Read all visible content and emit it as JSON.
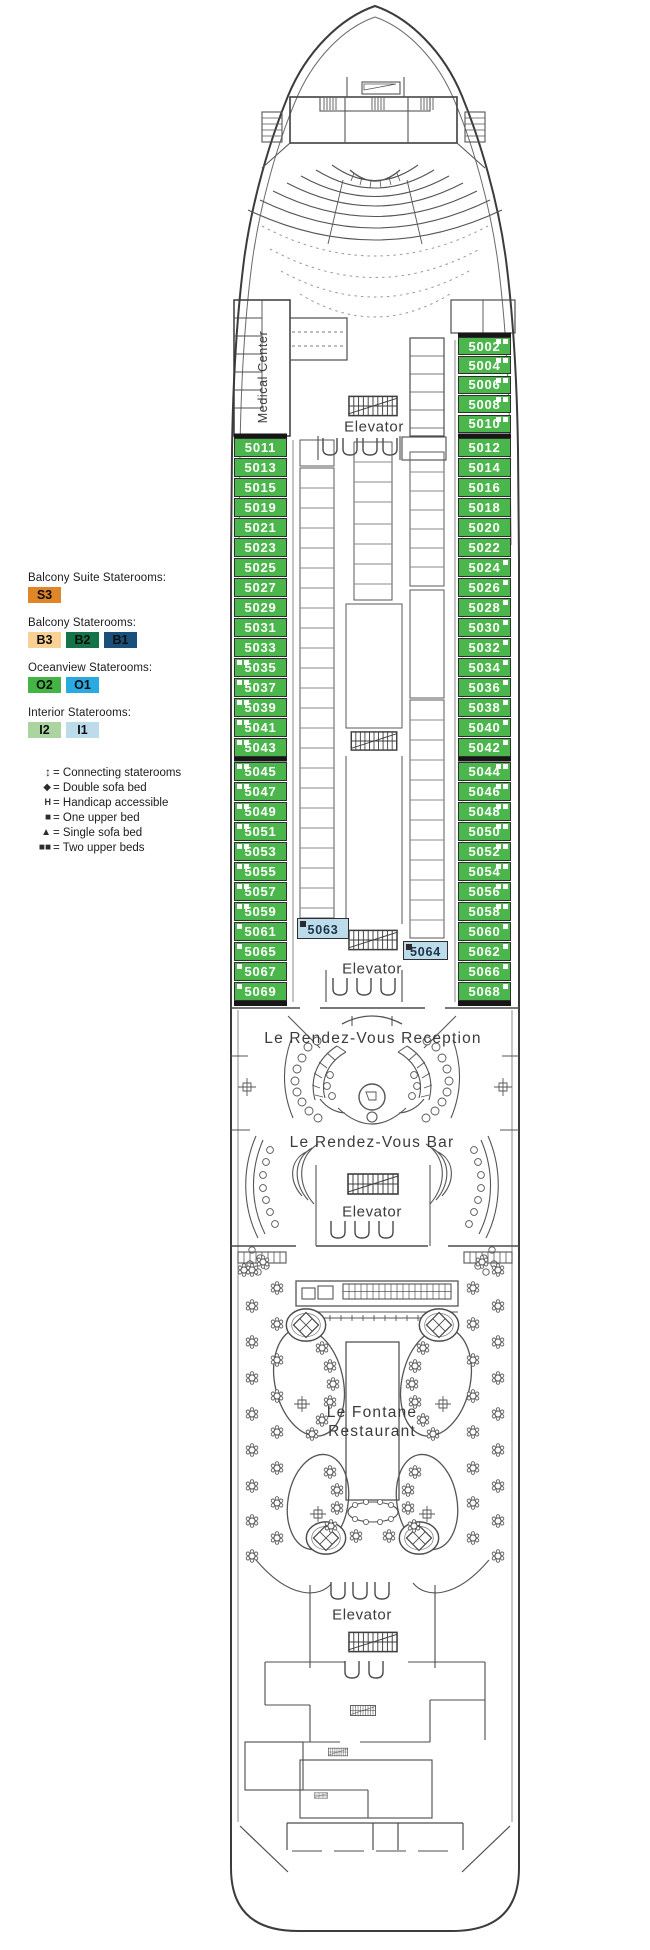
{
  "labels": {
    "medical_center": "Medical Center",
    "elevator": "Elevator",
    "reception": "Le Rendez-Vous Reception",
    "bar": "Le Rendez-Vous Bar",
    "restaurant_line1": "Le Fontane",
    "restaurant_line2": "Restaurant"
  },
  "legend": {
    "categories": [
      {
        "id": "balcony-suite",
        "label": "Balcony Suite Staterooms:",
        "swatches": [
          {
            "code": "S3",
            "color": "#e08629"
          }
        ]
      },
      {
        "id": "balcony",
        "label": "Balcony Staterooms:",
        "swatches": [
          {
            "code": "B3",
            "color": "#fad095"
          },
          {
            "code": "B2",
            "color": "#157348"
          },
          {
            "code": "B1",
            "color": "#185079"
          }
        ]
      },
      {
        "id": "oceanview",
        "label": "Oceanview Staterooms:",
        "swatches": [
          {
            "code": "O2",
            "color": "#44b545"
          },
          {
            "code": "O1",
            "color": "#29abe2"
          }
        ]
      },
      {
        "id": "interior",
        "label": "Interior Staterooms:",
        "swatches": [
          {
            "code": "I2",
            "color": "#aad4a0"
          },
          {
            "code": "I1",
            "color": "#bcdcec"
          }
        ]
      }
    ],
    "symbols": [
      {
        "icon": "connecting-staterooms-icon",
        "glyph": "↕",
        "label": "= Connecting staterooms",
        "cls": "ico-connecting"
      },
      {
        "icon": "double-sofa-bed-icon",
        "glyph": "◆",
        "label": "= Double sofa bed",
        "cls": ""
      },
      {
        "icon": "handicap-accessible-icon",
        "glyph": "H",
        "label": "= Handicap accessible",
        "cls": "ico-handicap"
      },
      {
        "icon": "one-upper-bed-icon",
        "glyph": "■",
        "label": "= One upper bed",
        "cls": ""
      },
      {
        "icon": "single-sofa-bed-icon",
        "glyph": "▲",
        "label": "= Single sofa bed",
        "cls": ""
      },
      {
        "icon": "two-upper-beds-icon",
        "glyph": "■■",
        "label": "= Two upper beds",
        "cls": "ico-two"
      }
    ]
  },
  "staterooms": {
    "oceanview_color": "#4bb64c",
    "number_color": "#ffffff",
    "interior_color": "#bcdcec",
    "interior_number_color": "#1c3345",
    "groups": {
      "left_fwd": [
        {
          "n": "5011",
          "m": 0
        },
        {
          "n": "5013",
          "m": 0
        },
        {
          "n": "5015",
          "m": 0
        },
        {
          "n": "5019",
          "m": 0
        },
        {
          "n": "5021",
          "m": 0
        },
        {
          "n": "5023",
          "m": 0
        },
        {
          "n": "5025",
          "m": 0
        },
        {
          "n": "5027",
          "m": 0
        },
        {
          "n": "5029",
          "m": 0
        },
        {
          "n": "5031",
          "m": 0
        },
        {
          "n": "5033",
          "m": 0
        },
        {
          "n": "5035",
          "m": 2
        },
        {
          "n": "5037",
          "m": 2
        },
        {
          "n": "5039",
          "m": 2
        },
        {
          "n": "5041",
          "m": 2
        },
        {
          "n": "5043",
          "m": 2
        }
      ],
      "left_aft": [
        {
          "n": "5045",
          "m": 2
        },
        {
          "n": "5047",
          "m": 2
        },
        {
          "n": "5049",
          "m": 2
        },
        {
          "n": "5051",
          "m": 2
        },
        {
          "n": "5053",
          "m": 2
        },
        {
          "n": "5055",
          "m": 2
        },
        {
          "n": "5057",
          "m": 2
        },
        {
          "n": "5059",
          "m": 2
        },
        {
          "n": "5061",
          "m": 1
        },
        {
          "n": "5065",
          "m": 1
        },
        {
          "n": "5067",
          "m": 1
        },
        {
          "n": "5069",
          "m": 1
        }
      ],
      "right_fwd": [
        {
          "n": "5002",
          "m": 2
        },
        {
          "n": "5004",
          "m": 2
        },
        {
          "n": "5006",
          "m": 2
        },
        {
          "n": "5008",
          "m": 2
        },
        {
          "n": "5010",
          "m": 2
        }
      ],
      "right_mid": [
        {
          "n": "5012",
          "m": 0
        },
        {
          "n": "5014",
          "m": 0
        },
        {
          "n": "5016",
          "m": 0
        },
        {
          "n": "5018",
          "m": 0
        },
        {
          "n": "5020",
          "m": 0
        },
        {
          "n": "5022",
          "m": 0
        },
        {
          "n": "5024",
          "m": 1
        },
        {
          "n": "5026",
          "m": 1
        },
        {
          "n": "5028",
          "m": 1
        },
        {
          "n": "5030",
          "m": 1
        },
        {
          "n": "5032",
          "m": 1
        },
        {
          "n": "5034",
          "m": 1
        },
        {
          "n": "5036",
          "m": 1
        },
        {
          "n": "5038",
          "m": 1
        },
        {
          "n": "5040",
          "m": 1
        },
        {
          "n": "5042",
          "m": 1
        }
      ],
      "right_aft": [
        {
          "n": "5044",
          "m": 2
        },
        {
          "n": "5046",
          "m": 2
        },
        {
          "n": "5048",
          "m": 2
        },
        {
          "n": "5050",
          "m": 2
        },
        {
          "n": "5052",
          "m": 2
        },
        {
          "n": "5054",
          "m": 2
        },
        {
          "n": "5056",
          "m": 2
        },
        {
          "n": "5058",
          "m": 2
        },
        {
          "n": "5060",
          "m": 1
        },
        {
          "n": "5062",
          "m": 1
        },
        {
          "n": "5066",
          "m": 1
        },
        {
          "n": "5068",
          "m": 1
        }
      ]
    },
    "interior_rooms": [
      {
        "n": "5063",
        "m": 1
      },
      {
        "n": "5064",
        "m": 1
      }
    ]
  }
}
